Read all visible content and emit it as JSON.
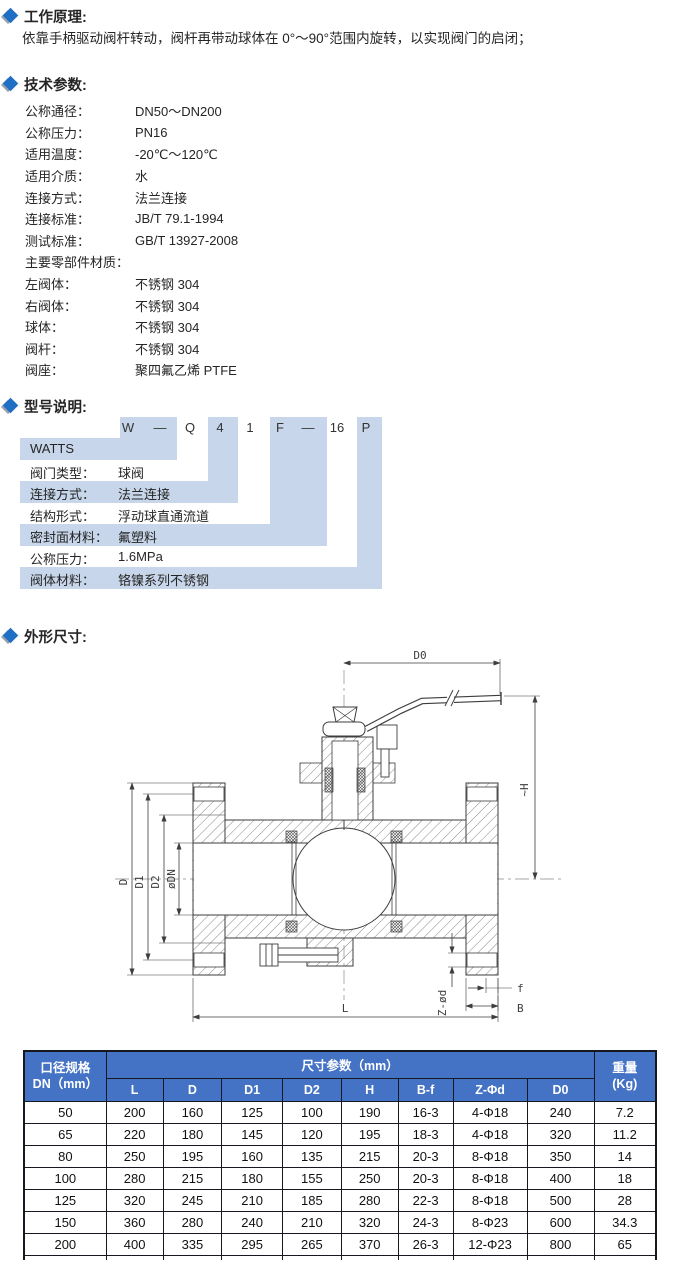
{
  "accent": {
    "heading_diamond_blue": "#1f6fc4",
    "heading_diamond_shadow": "#9aa3ad",
    "model_block_blue": "#c7d6ea",
    "table_header_blue": "#4472c4"
  },
  "working_principle": {
    "title": "工作原理:",
    "body": "依靠手柄驱动阀杆转动，阀杆再带动球体在 0°～90°范围内旋转，以实现阀门的启闭；"
  },
  "tech_params": {
    "title": "技术参数:",
    "rows": [
      {
        "label": "公称通径：",
        "value": "DN50～DN200"
      },
      {
        "label": "公称压力：",
        "value": "PN16"
      },
      {
        "label": "适用温度：",
        "value": "-20℃～120℃"
      },
      {
        "label": "适用介质：",
        "value": "水"
      },
      {
        "label": "连接方式：",
        "value": "法兰连接"
      },
      {
        "label": "连接标准：",
        "value": "JB/T 79.1-1994"
      },
      {
        "label": "测试标准：",
        "value": "GB/T 13927-2008"
      },
      {
        "label": "主要零部件材质：",
        "value": ""
      },
      {
        "label": "左阀体：",
        "value": "不锈钢 304"
      },
      {
        "label": "右阀体：",
        "value": "不锈钢 304"
      },
      {
        "label": "球体：",
        "value": "不锈钢 304"
      },
      {
        "label": "阀杆：",
        "value": "不锈钢 304"
      },
      {
        "label": "阀座：",
        "value": "聚四氟乙烯 PTFE"
      }
    ]
  },
  "model": {
    "title": "型号说明:",
    "code": [
      "W",
      "—",
      "Q",
      "4",
      "1",
      "F",
      "—",
      "16",
      "P"
    ],
    "rows": [
      {
        "label": "WATTS",
        "value": ""
      },
      {
        "label": "阀门类型：",
        "value": "球阀"
      },
      {
        "label": "连接方式：",
        "value": "法兰连接"
      },
      {
        "label": "结构形式：",
        "value": "浮动球直通流道"
      },
      {
        "label": "密封面材料：",
        "value": "氟塑料"
      },
      {
        "label": "公称压力：",
        "value": "1.6MPa"
      },
      {
        "label": "阀体材料：",
        "value": "铬镍系列不锈钢"
      }
    ]
  },
  "dimensions_section": {
    "title": "外形尺寸:",
    "labels": {
      "d0": "D0",
      "h": "~H",
      "d": "D",
      "d1": "D1",
      "d2": "D2",
      "dn": "øDN",
      "z": "Z-ød",
      "f": "f",
      "b": "B",
      "l": "L"
    }
  },
  "table": {
    "header": {
      "col1_top": "口径规格",
      "col1_bottom": "DN（mm）",
      "span_title": "尺寸参数（mm）",
      "cols": [
        "L",
        "D",
        "D1",
        "D2",
        "H",
        "B-f",
        "Z-Φd",
        "D0"
      ],
      "weight_top": "重量",
      "weight_bottom": "(Kg)"
    },
    "rows": [
      [
        "50",
        "200",
        "160",
        "125",
        "100",
        "190",
        "16-3",
        "4-Φ18",
        "240",
        "7.2"
      ],
      [
        "65",
        "220",
        "180",
        "145",
        "120",
        "195",
        "18-3",
        "4-Φ18",
        "320",
        "11.2"
      ],
      [
        "80",
        "250",
        "195",
        "160",
        "135",
        "215",
        "20-3",
        "8-Φ18",
        "350",
        "14"
      ],
      [
        "100",
        "280",
        "215",
        "180",
        "155",
        "250",
        "20-3",
        "8-Φ18",
        "400",
        "18"
      ],
      [
        "125",
        "320",
        "245",
        "210",
        "185",
        "280",
        "22-3",
        "8-Φ18",
        "500",
        "28"
      ],
      [
        "150",
        "360",
        "280",
        "240",
        "210",
        "320",
        "24-3",
        "8-Φ23",
        "600",
        "34.3"
      ],
      [
        "200",
        "400",
        "335",
        "295",
        "265",
        "370",
        "26-3",
        "12-Φ23",
        "800",
        "65"
      ]
    ]
  }
}
